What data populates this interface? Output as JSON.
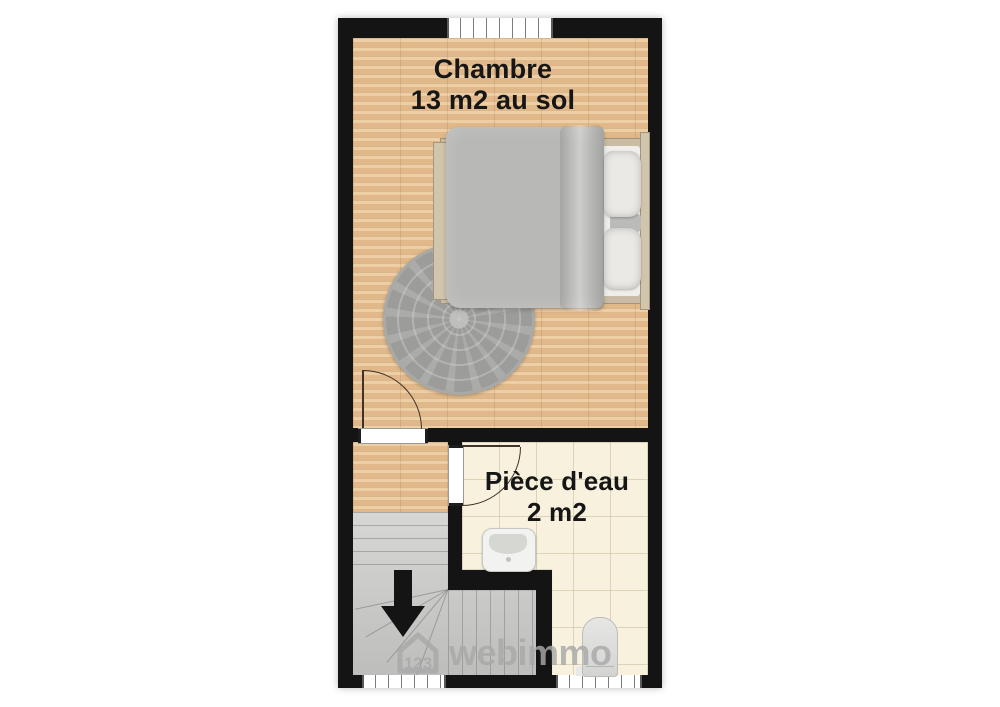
{
  "floor_plan": {
    "rooms": [
      {
        "name": "Chambre",
        "area": "13 m2 au sol"
      },
      {
        "name": "Pièce d'eau",
        "area": "2 m2"
      }
    ],
    "watermark": {
      "number": "123",
      "brand": "webimmo"
    },
    "colors": {
      "wall": "#141414",
      "wood_floor": "#e5c094",
      "tile_floor": "#f7f1de",
      "stairs": "#c9c9c7",
      "rug": "#9c9c9a",
      "bed_duvet": "#b8b8b6",
      "bed_frame": "#d2c5ae",
      "watermark": "#a9a9a9"
    },
    "icons": [
      "stairs-down-arrow-icon",
      "watermark-house-icon"
    ]
  }
}
